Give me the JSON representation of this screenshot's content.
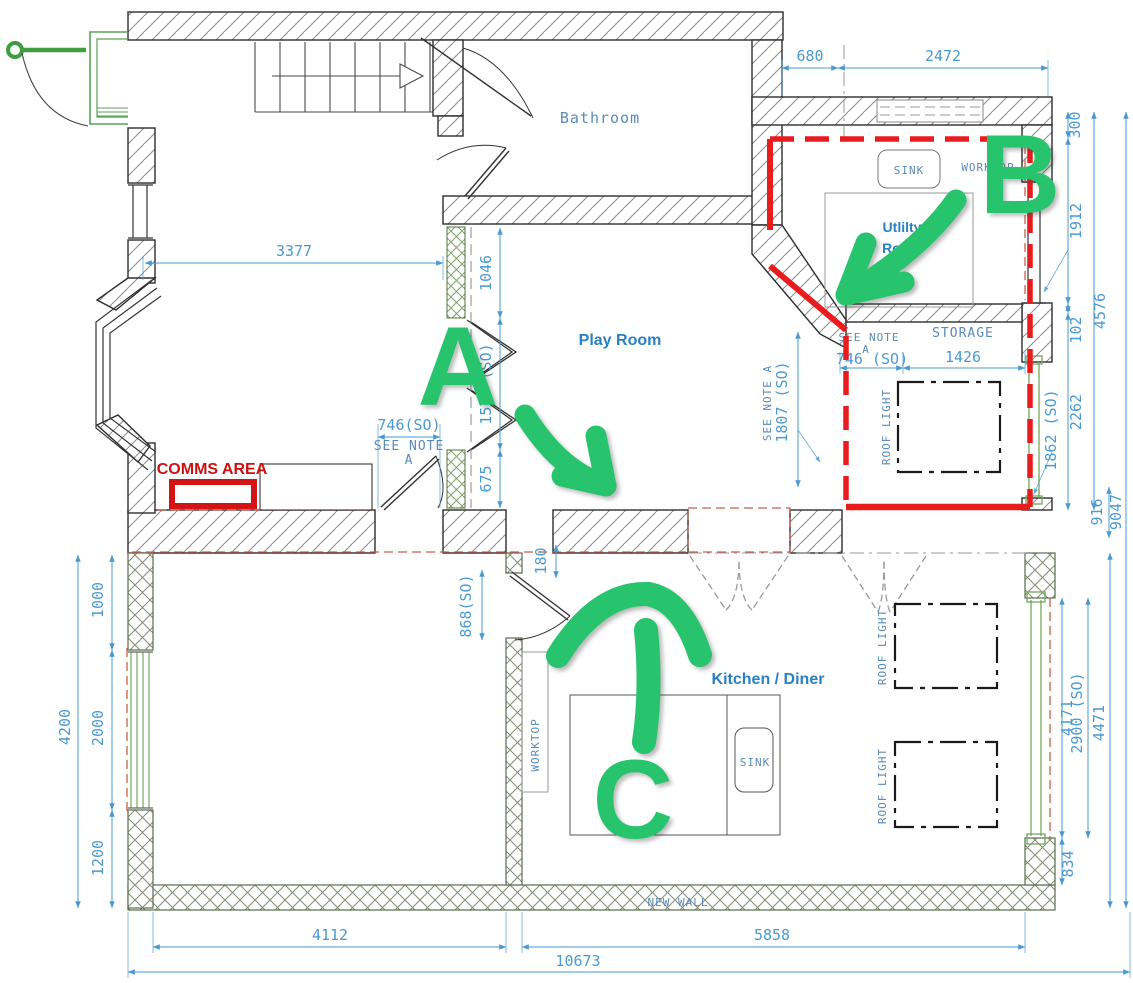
{
  "title": "Ground floor plan with survey dimensions and proposal markers",
  "colors": {
    "dimension_blue": "#4a9ad2",
    "cad_label_blue": "#5b8ab8",
    "room_label_blue": "#2980c4",
    "annotation_green": "#27c46d",
    "highlight_red": "#e81c1c",
    "comms_red": "#cf1010",
    "old_wall_red_dash": "#c4614f"
  },
  "rooms": {
    "bathroom": "Bathroom",
    "play_room": "Play Room",
    "utility_line1": "Utlilty",
    "utility_line2": "Room",
    "kitchen_diner": "Kitchen / Diner",
    "storage": "STORAGE"
  },
  "fixtures": {
    "sink_utility": "SINK",
    "worktop_utility": "WORKTOP",
    "sink_kitchen": "SINK",
    "worktop_kitchen": "WORKTOP",
    "roof_light_storage": "ROOF LIGHT",
    "roof_light_kitchen_1": "ROOF LIGHT",
    "roof_light_kitchen_2": "ROOF LIGHT",
    "new_wall": "NEW WALL"
  },
  "annotations": {
    "comms_area": "COMMS AREA",
    "marker_a": "A",
    "marker_b": "B",
    "marker_c": "C"
  },
  "notes": {
    "see_note": "SEE NOTE",
    "see_note_ref": "A",
    "see_note_inline": "SEE NOTE A"
  },
  "dims": {
    "d680": "680",
    "d2472": "2472",
    "d3377": "3377",
    "d1046": "1046",
    "d1578": "1578 (SO)",
    "d675": "675",
    "d746_door": "746(SO)",
    "d868": "868(SO)",
    "d180": "180",
    "d300": "300",
    "d1912": "1912",
    "d102": "102",
    "d4576": "4576",
    "d2262": "2262",
    "d1862": "1862 (SO)",
    "d916": "916",
    "d9047": "9047",
    "d746_storage": "746 (SO)",
    "d1426": "1426",
    "d1807": "1807 (SO)",
    "d1000": "1000",
    "d2000": "2000",
    "d1200": "1200",
    "d4200": "4200",
    "d4112": "4112",
    "d5858": "5858",
    "d10673": "10673",
    "d4171": "4171",
    "d2900": "2900 (SO)",
    "d4471": "4471",
    "d834": "834"
  }
}
